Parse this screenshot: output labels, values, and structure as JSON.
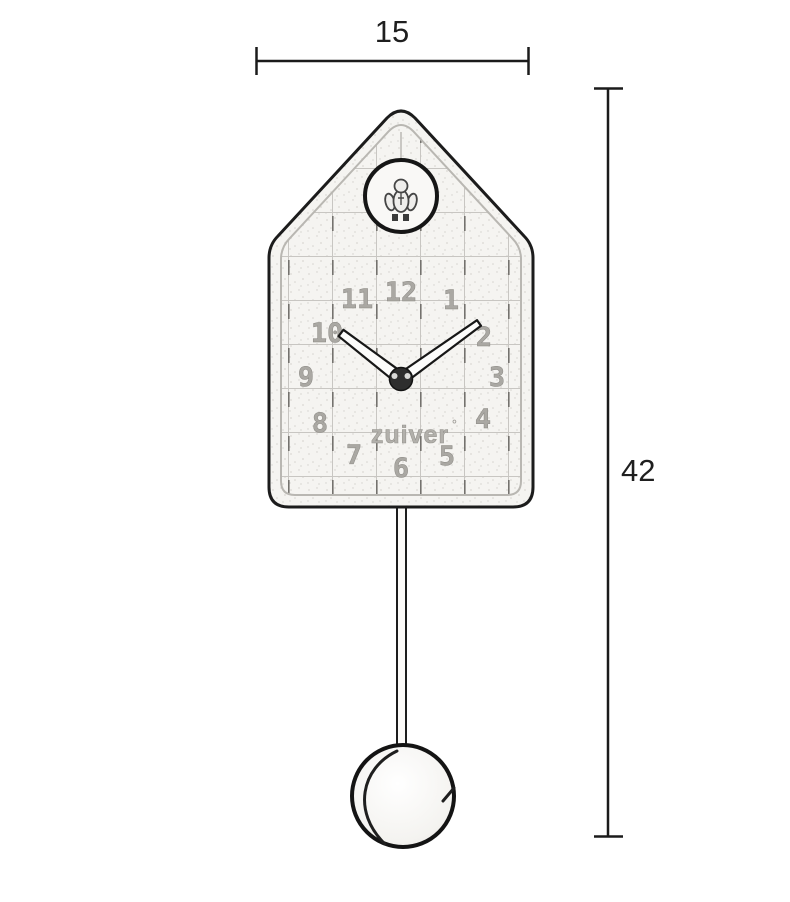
{
  "diagram": {
    "type": "product-dimension-drawing",
    "subject": "house-shaped cuckoo pendulum wall clock",
    "background_color": "#ffffff"
  },
  "dimensions": {
    "width_label": "15",
    "height_label": "42"
  },
  "clock": {
    "brand_label": "zuiver",
    "brand_mark": "°",
    "numerals": [
      "12",
      "1",
      "2",
      "3",
      "4",
      "5",
      "6",
      "7",
      "8",
      "9",
      "10",
      "11"
    ],
    "hands_time": "10:10"
  },
  "colors": {
    "line": "#1b1b1b",
    "grid": "#c8c6c2",
    "grid_tick": "#74726e",
    "emboss": "#aaa8a3",
    "face": "#f5f4f1"
  }
}
